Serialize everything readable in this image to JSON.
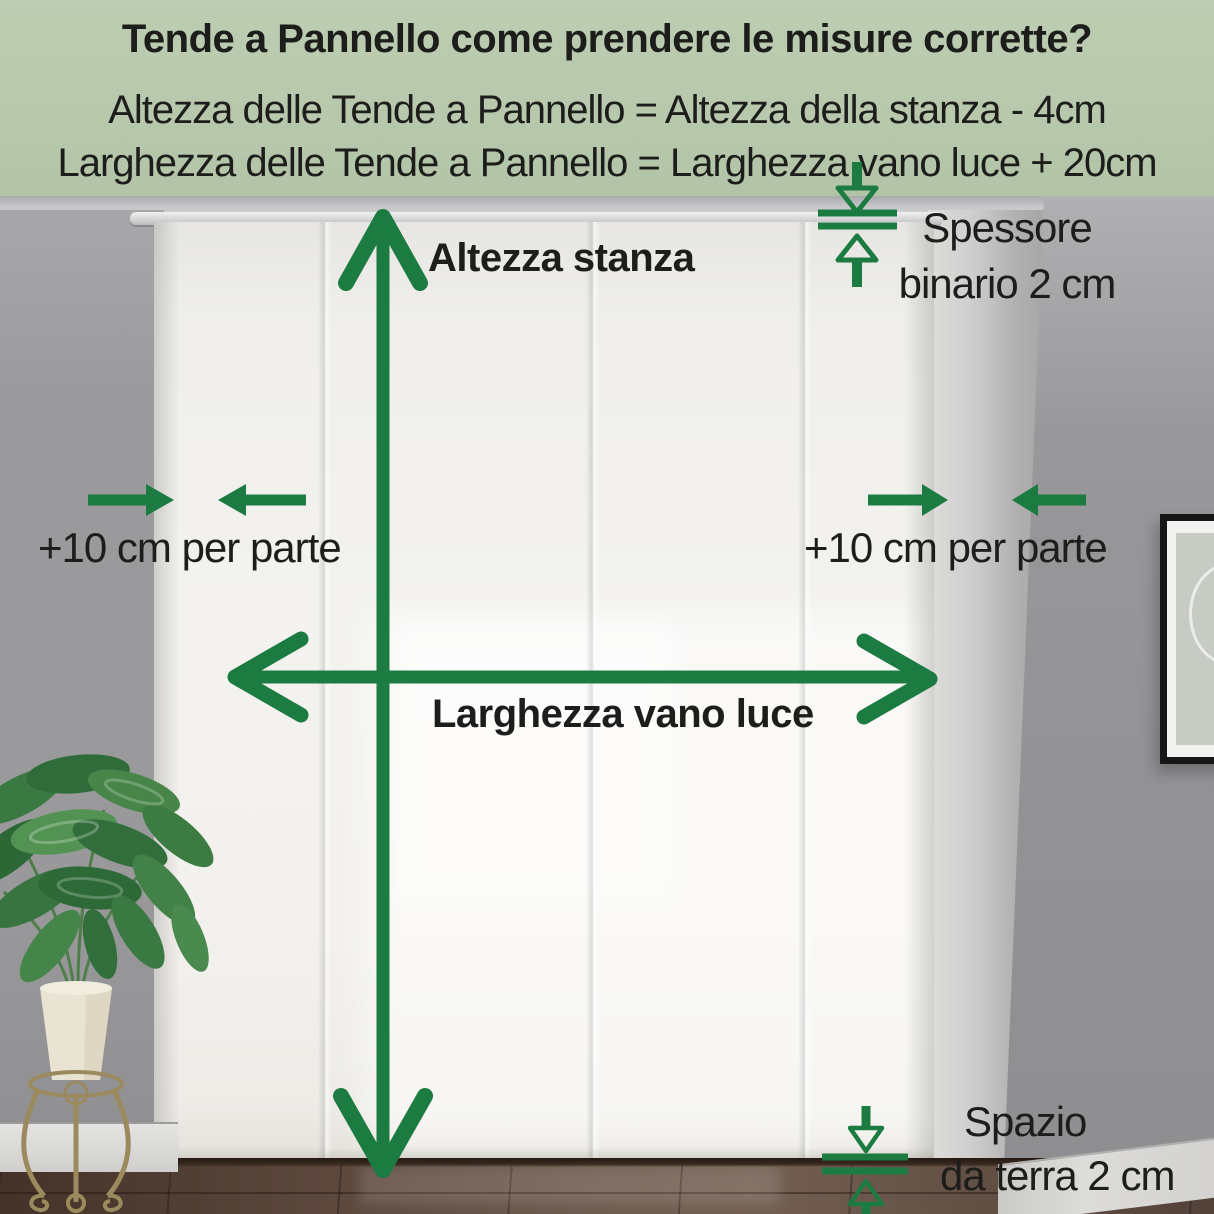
{
  "header": {
    "title": "Tende a Pannello come prendere le misure corrette?",
    "formulas": [
      "Altezza delle Tende a Pannello = Altezza della stanza - 4cm",
      "Larghezza delle Tende a Pannello = Larghezza vano luce + 20cm"
    ],
    "bg_color": "#b7c8ac",
    "text_color": "#1d1d1b"
  },
  "diagram": {
    "arrow_color": "#1c7b40",
    "labels": {
      "room_height": "Altezza stanza",
      "opening_width": "Larghezza vano luce",
      "side_margin_left": "+10 cm per parte",
      "side_margin_right": "+10 cm per parte",
      "rail_thickness_line1": "Spessore",
      "rail_thickness_line2": "binario 2 cm",
      "floor_gap_line1": "Spazio",
      "floor_gap_line2": "da terra 2 cm"
    }
  }
}
